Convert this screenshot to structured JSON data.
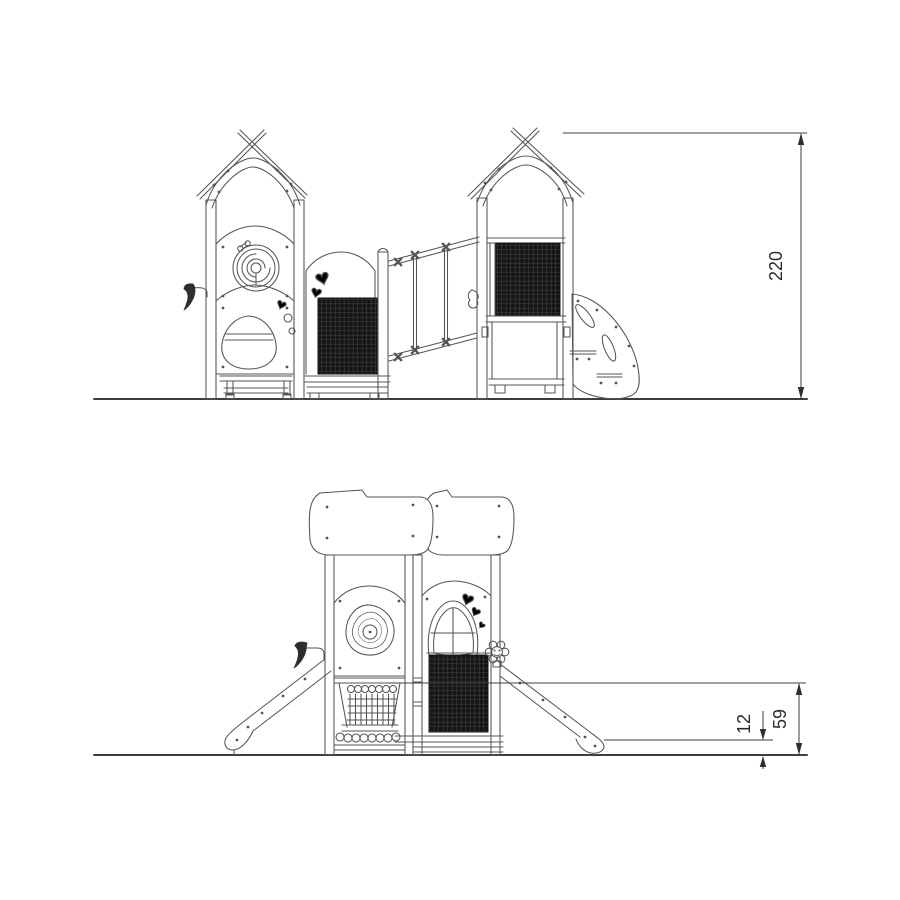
{
  "colors": {
    "background": "#ffffff",
    "line": "#555555",
    "dark_panel": "#141414",
    "dimension_text": "#2b2b2b"
  },
  "side_elevation": {
    "view_name": "side-elevation",
    "overall_height": "220"
  },
  "front_elevation": {
    "view_name": "front-elevation",
    "platform_height": "59",
    "slide_exit_height": "12"
  }
}
